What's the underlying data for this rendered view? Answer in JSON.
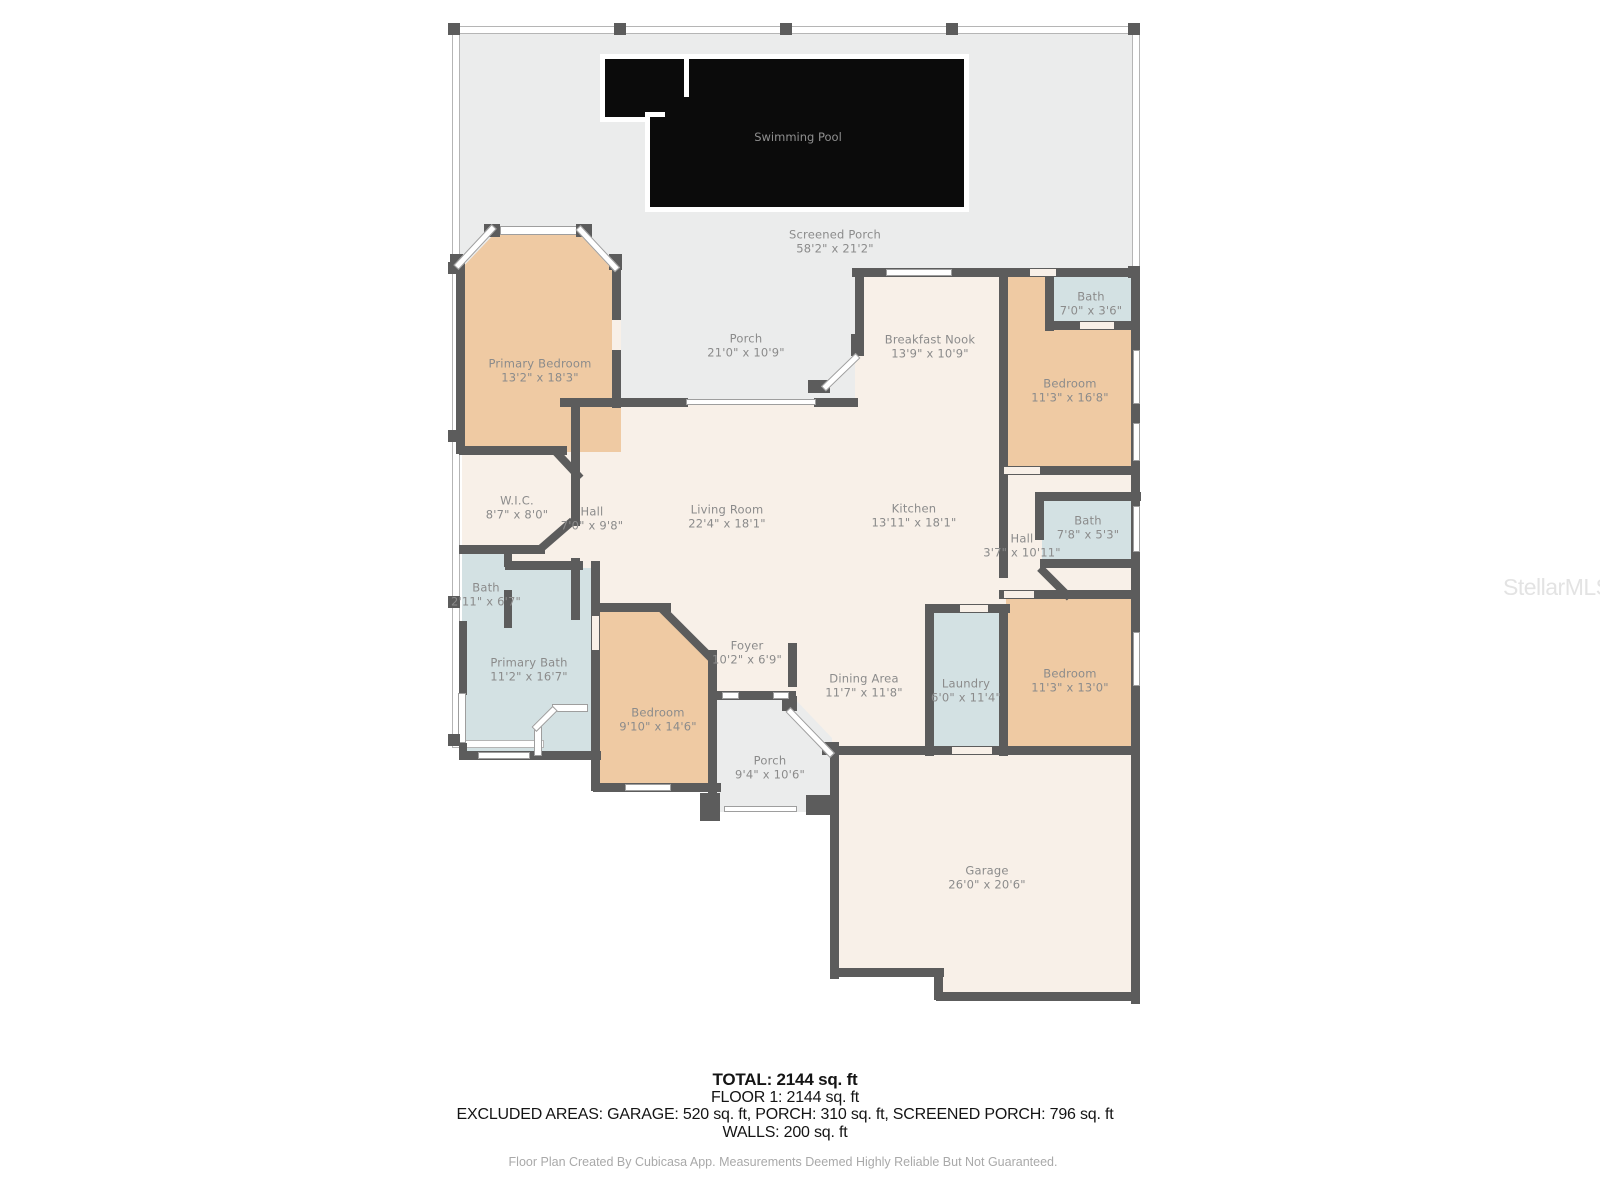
{
  "rooms": {
    "screened_porch": {
      "name": "Screened Porch",
      "dims": "58'2\" x 21'2\""
    },
    "swimming_pool": {
      "name": "Swimming Pool",
      "dims": ""
    },
    "porch_back": {
      "name": "Porch",
      "dims": "21'0\" x 10'9\""
    },
    "primary_bedroom": {
      "name": "Primary Bedroom",
      "dims": "13'2\" x 18'3\""
    },
    "breakfast_nook": {
      "name": "Breakfast Nook",
      "dims": "13'9\" x 10'9\""
    },
    "bath_top_right": {
      "name": "Bath",
      "dims": "7'0\" x 3'6\""
    },
    "bedroom_right_upper": {
      "name": "Bedroom",
      "dims": "11'3\" x 16'8\""
    },
    "wic": {
      "name": "W.I.C.",
      "dims": "8'7\" x 8'0\""
    },
    "hall_left": {
      "name": "Hall",
      "dims": "7'0\" x 9'8\""
    },
    "living_room": {
      "name": "Living Room",
      "dims": "22'4\" x 18'1\""
    },
    "kitchen": {
      "name": "Kitchen",
      "dims": "13'11\" x 18'1\""
    },
    "hall_right": {
      "name": "Hall",
      "dims": "3'7\" x 10'11\""
    },
    "bath_right": {
      "name": "Bath",
      "dims": "7'8\" x 5'3\""
    },
    "bath_left": {
      "name": "Bath",
      "dims": "2'11\" x 6'7\""
    },
    "primary_bath": {
      "name": "Primary Bath",
      "dims": "11'2\" x 16'7\""
    },
    "foyer": {
      "name": "Foyer",
      "dims": "10'2\" x 6'9\""
    },
    "dining_area": {
      "name": "Dining Area",
      "dims": "11'7\" x 11'8\""
    },
    "laundry": {
      "name": "Laundry",
      "dims": "6'0\" x 11'4\""
    },
    "bedroom_right_lower": {
      "name": "Bedroom",
      "dims": "11'3\" x 13'0\""
    },
    "bedroom_bottom": {
      "name": "Bedroom",
      "dims": "9'10\" x 14'6\""
    },
    "porch_front": {
      "name": "Porch",
      "dims": "9'4\" x 10'6\""
    },
    "garage": {
      "name": "Garage",
      "dims": "26'0\" x 20'6\""
    }
  },
  "summary": {
    "total": "TOTAL: 2144 sq. ft",
    "floor1": "FLOOR 1: 2144 sq. ft",
    "excluded": "EXCLUDED AREAS: GARAGE: 520 sq. ft, PORCH: 310 sq. ft, SCREENED PORCH: 796 sq. ft",
    "walls": "WALLS: 200 sq. ft",
    "credit": "Floor Plan Created By Cubicasa App. Measurements Deemed Highly Reliable But Not Guaranteed."
  },
  "watermark": "StellarMLS",
  "colors": {
    "wall": "#5c5c5c",
    "floor_gray": "#ebecec",
    "floor_cream": "#f8f0e8",
    "room_tan": "#efcaa3",
    "room_blue": "#d3e1e3",
    "pool": "#0b0b0b"
  }
}
